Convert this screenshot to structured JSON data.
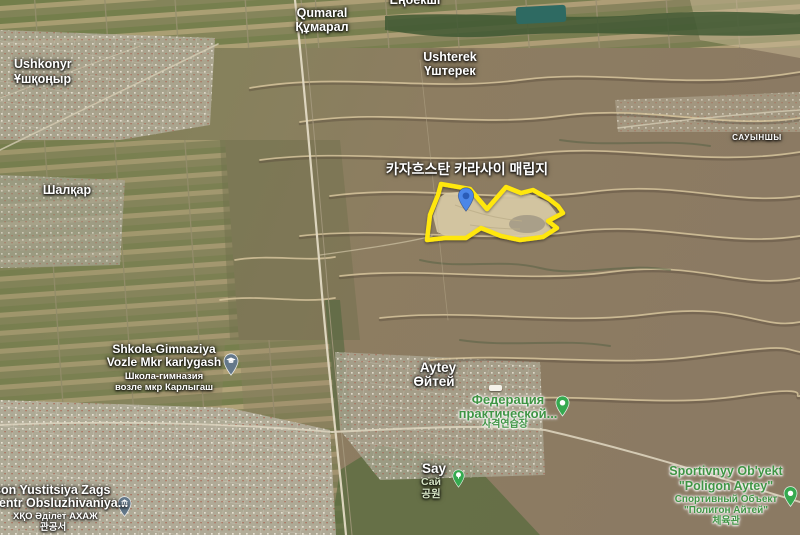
{
  "site": {
    "label": "카자흐스탄 카라사이 매립지",
    "boundary_color": "#ffe70a"
  },
  "places": {
    "qumaral": {
      "latin": "Qumaral",
      "kazakh": "Құмарал"
    },
    "enbekshi": {
      "kazakh": "Еңбекші"
    },
    "ushkonyr": {
      "latin": "Ushkonyr",
      "kazakh": "Ұшқоңыр"
    },
    "ushterek": {
      "latin": "Ushterek",
      "kazakh": "Үштерек"
    },
    "sauynshy": {
      "kazakh": "САУЫНШЫ"
    },
    "shalqar": {
      "kazakh": "Шалқар"
    },
    "aytey": {
      "latin": "Aytey",
      "kazakh": "Өйтей"
    }
  },
  "pois": {
    "school": {
      "line1": "Shkola-Gimnaziya",
      "line2": "Vozle Mkr karlygash",
      "line3": "Школа-гимназия",
      "line4": "возле мкр Карлыгаш"
    },
    "shooting_federation": {
      "line1": "Федерация",
      "line2": "практической...",
      "line3": "사격연습장"
    },
    "say_park": {
      "latin": "Say",
      "cyrillic": "Сай",
      "korean": "공원"
    },
    "sport_object": {
      "line1": "Sportivnyy Ob'yekt",
      "line2": "\"Poligon Aytey\"",
      "line3": "Спортивный Объект",
      "line4": "\"Полигон Айтей\"",
      "line5": "체육관"
    },
    "justice_center": {
      "line1": "son Yustitsiya Zags",
      "line2": "sentr Obsluzhivaniya...",
      "line3": "ХҚО Әділет АХАЖ",
      "line4": "관공서"
    }
  },
  "markers": {
    "site_pin_color": "#4c87e8",
    "site_pin_dot_color": "#2a5cb8",
    "gray_poi_pin_color": "#64788a",
    "green_poi_pin_color": "#35a94f"
  }
}
